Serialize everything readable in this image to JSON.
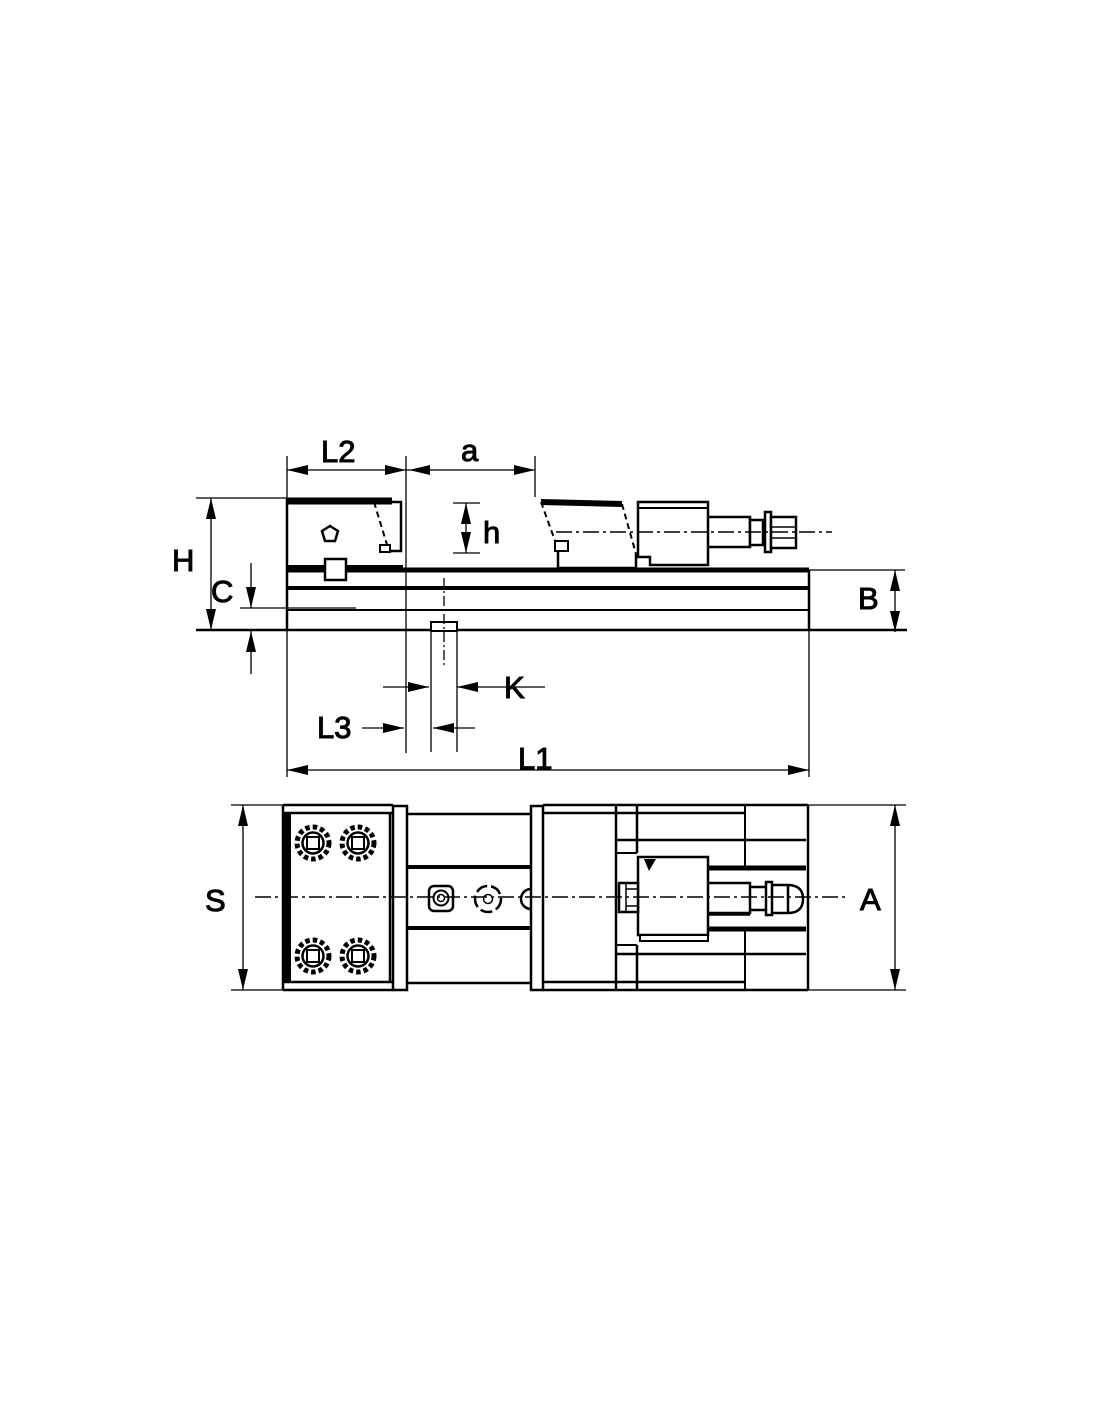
{
  "drawing": {
    "description": "Two-view dimensioned technical drawing of a machine vise (side elevation and top plan view)",
    "colors": {
      "line": "#000000",
      "background": "#ffffff"
    },
    "labels": {
      "L2": "L2",
      "a": "a",
      "h": "h",
      "H": "H",
      "C": "C",
      "B": "B",
      "K": "K",
      "L3": "L3",
      "L1": "L1",
      "S": "S",
      "A": "A"
    }
  }
}
